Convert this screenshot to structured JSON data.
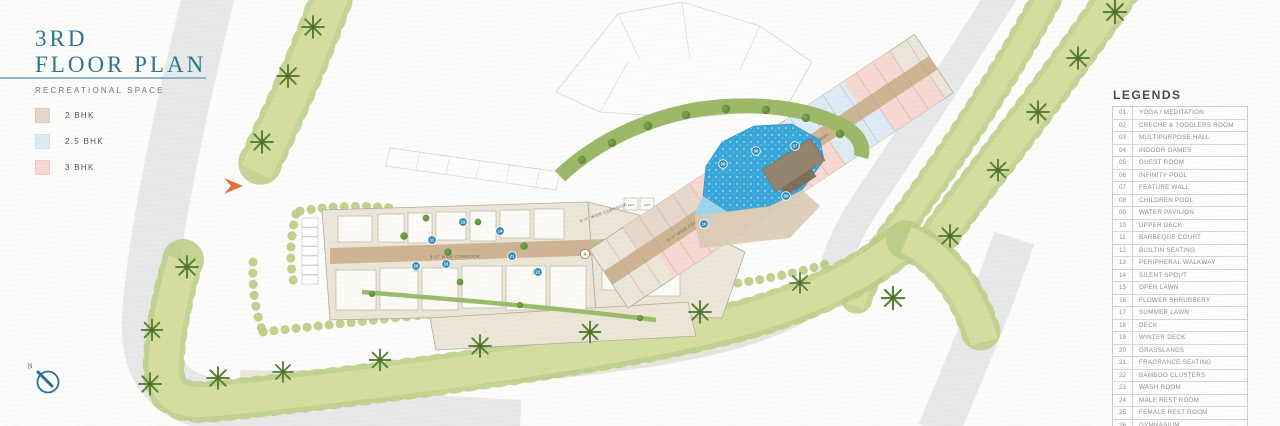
{
  "header": {
    "title_line1": "3RD",
    "title_line2": "FLOOR PLAN",
    "subtitle": "RECREATIONAL SPACE"
  },
  "unit_legend": [
    {
      "label": "2 BHK",
      "color": "#e7d7c9"
    },
    {
      "label": "2.5 BHK",
      "color": "#dcebf6"
    },
    {
      "label": "3 BHK",
      "color": "#f7d8d2"
    }
  ],
  "legends": {
    "title": "LEGENDS",
    "items": [
      {
        "no": "01",
        "label": "YOGA / MEDITATION"
      },
      {
        "no": "02",
        "label": "CRECHE & TODDLERS ROOM"
      },
      {
        "no": "03",
        "label": "MULTIPURPOSE HALL"
      },
      {
        "no": "04",
        "label": "INDOOR GAMES"
      },
      {
        "no": "05",
        "label": "GUEST ROOM"
      },
      {
        "no": "06",
        "label": "INFINITY POOL"
      },
      {
        "no": "07",
        "label": "FEATURE WALL"
      },
      {
        "no": "08",
        "label": "CHILDREN POOL"
      },
      {
        "no": "09",
        "label": "WATER PAVILION"
      },
      {
        "no": "10",
        "label": "UPPER DECK"
      },
      {
        "no": "11",
        "label": "BARBEQUE COURT"
      },
      {
        "no": "12",
        "label": "BUILTIN SEATING"
      },
      {
        "no": "13",
        "label": "PERIPHERAL WALKWAY"
      },
      {
        "no": "14",
        "label": "SILENT SPOUT"
      },
      {
        "no": "15",
        "label": "OPEN LAWN"
      },
      {
        "no": "16",
        "label": "FLOWER SHRUBBERY"
      },
      {
        "no": "17",
        "label": "SUMMER LAWN"
      },
      {
        "no": "18",
        "label": "DECK"
      },
      {
        "no": "19",
        "label": "WINTER DECK"
      },
      {
        "no": "20",
        "label": "GRASSLANDS"
      },
      {
        "no": "21",
        "label": "FRAGRANCE SEATING"
      },
      {
        "no": "22",
        "label": "BAMBOO CLUSTERS"
      },
      {
        "no": "23",
        "label": "WASH ROOM"
      },
      {
        "no": "24",
        "label": "MALE REST ROOM"
      },
      {
        "no": "25",
        "label": "FEMALE REST ROOM"
      },
      {
        "no": "26",
        "label": "GYMNASIUM"
      }
    ]
  },
  "compass": {
    "label": "N"
  },
  "plan": {
    "labels": {
      "corridor": "6'-0\" WIDE CORRIDOR",
      "lift_lobby": "LIFT LOBBY",
      "lift": "LIFT",
      "block_marker": "A"
    },
    "markers": [
      {
        "no": "06",
        "x": 756,
        "y": 151
      },
      {
        "no": "07",
        "x": 795,
        "y": 146
      },
      {
        "no": "08",
        "x": 723,
        "y": 164
      },
      {
        "no": "09",
        "x": 786,
        "y": 196
      },
      {
        "no": "10",
        "x": 704,
        "y": 224
      },
      {
        "no": "14",
        "x": 500,
        "y": 231
      },
      {
        "no": "11",
        "x": 432,
        "y": 240
      },
      {
        "no": "15",
        "x": 463,
        "y": 222
      },
      {
        "no": "16",
        "x": 446,
        "y": 264
      },
      {
        "no": "20",
        "x": 416,
        "y": 266
      },
      {
        "no": "21",
        "x": 512,
        "y": 256
      },
      {
        "no": "22",
        "x": 538,
        "y": 272
      }
    ],
    "colors": {
      "accent_teal": "#2f7292",
      "road_gray": "#e7e8ea",
      "grass_band": "#d6de9f",
      "bush_green": "#b9cc82",
      "palm_green": "#5d8038",
      "lawn_green": "#90bf50",
      "pool_blue": "#38a6d8",
      "building_beige": "#ece6d8",
      "corridor_tan": "#cdb493",
      "marker_blue": "#2b86b8",
      "compass_blue": "#2a6f97",
      "entry_arrow_orange": "#e46f3d"
    }
  }
}
